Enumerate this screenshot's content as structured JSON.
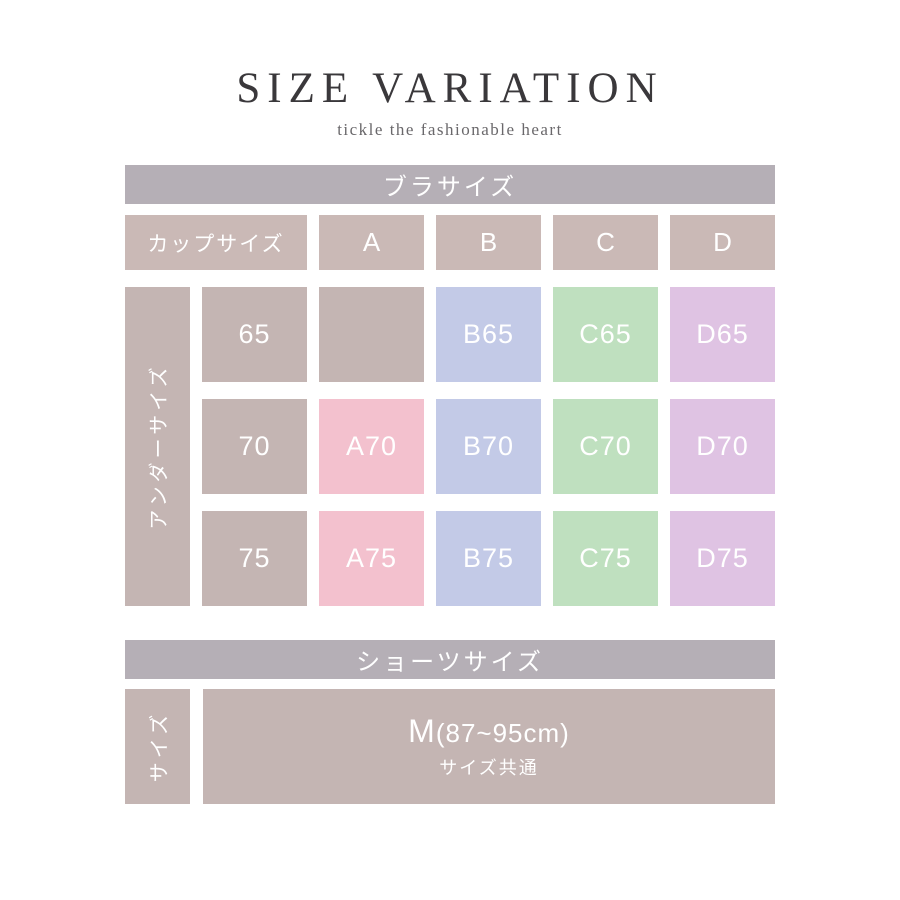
{
  "header": {
    "title": "SIZE VARIATION",
    "subtitle": "tickle the fashionable heart"
  },
  "bra": {
    "section_title": "ブラサイズ",
    "corner_label": "カップサイズ",
    "cup_labels": [
      "A",
      "B",
      "C",
      "D"
    ],
    "under_axis_label": "アンダーサイズ",
    "rows": [
      {
        "under": "65",
        "cells": [
          {
            "text": "",
            "color": "taupe"
          },
          {
            "text": "B65",
            "color": "blue"
          },
          {
            "text": "C65",
            "color": "green"
          },
          {
            "text": "D65",
            "color": "purple"
          }
        ]
      },
      {
        "under": "70",
        "cells": [
          {
            "text": "A70",
            "color": "pink"
          },
          {
            "text": "B70",
            "color": "blue"
          },
          {
            "text": "C70",
            "color": "green"
          },
          {
            "text": "D70",
            "color": "purple"
          }
        ]
      },
      {
        "under": "75",
        "cells": [
          {
            "text": "A75",
            "color": "pink"
          },
          {
            "text": "B75",
            "color": "blue"
          },
          {
            "text": "C75",
            "color": "green"
          },
          {
            "text": "D75",
            "color": "purple"
          }
        ]
      }
    ]
  },
  "shorts": {
    "section_title": "ショーツサイズ",
    "side_label": "サイズ",
    "size_main": "M",
    "size_range": "(87~95cm)",
    "size_note": "サイズ共通"
  },
  "colors": {
    "bar": "#b5afb6",
    "taupe": "#c4b5b3",
    "taupe-header": "#cab9b6",
    "pink": "#f3c1ce",
    "blue": "#c3cae7",
    "green": "#bfe0bf",
    "purple": "#dfc3e3",
    "title-text": "#3a383b",
    "subtitle-text": "#6a686b",
    "cell-text": "#ffffff"
  }
}
